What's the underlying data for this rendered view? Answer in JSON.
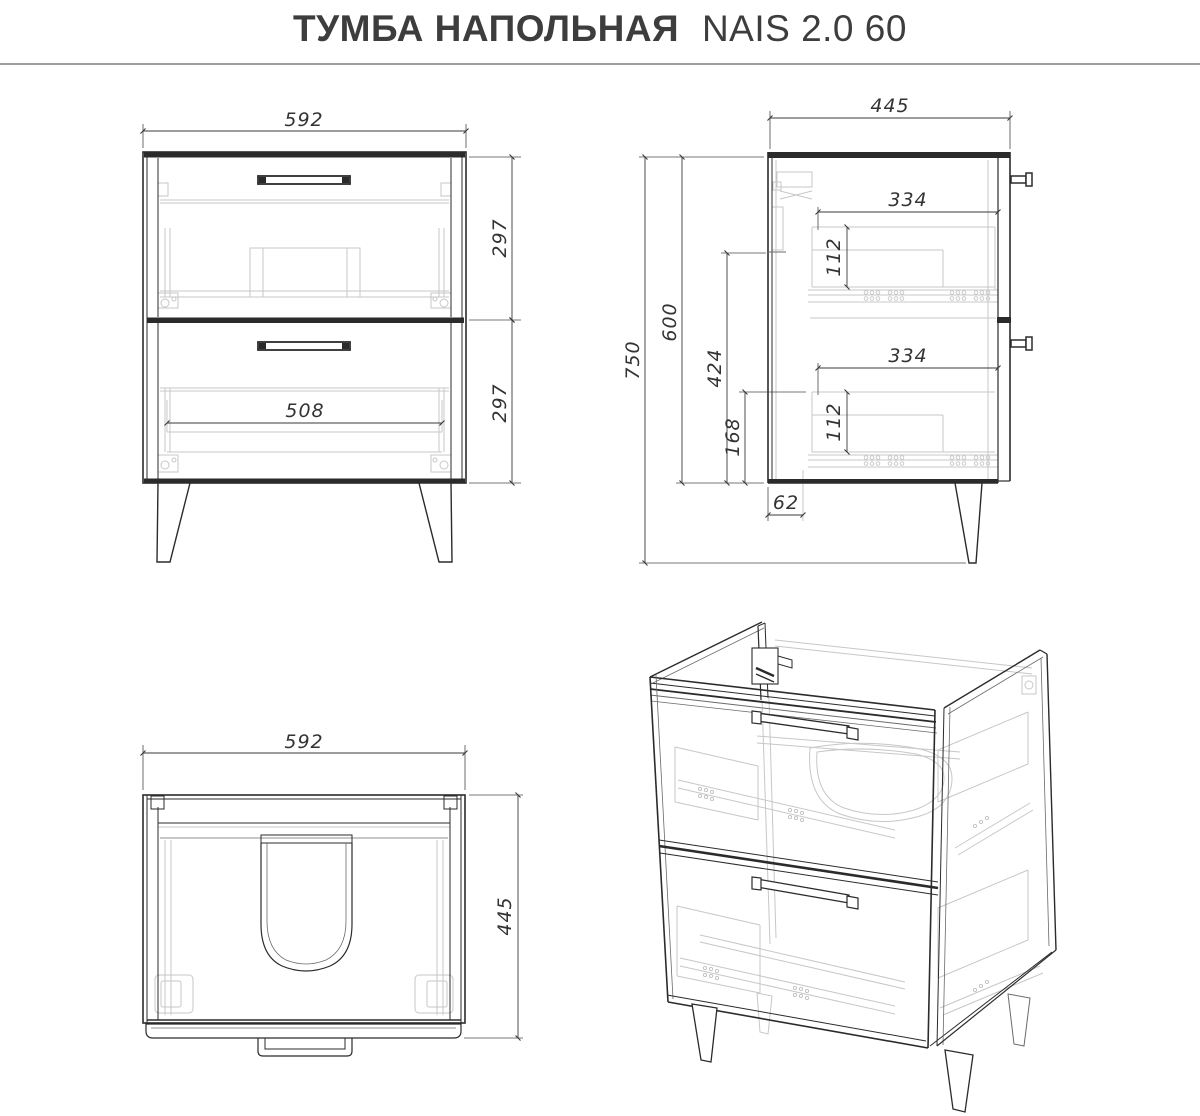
{
  "title": {
    "product": "ТУМБА НАПОЛЬНАЯ",
    "model": "NAIS 2.0 60"
  },
  "colors": {
    "background": "#ffffff",
    "line_main": "#2b2b2b",
    "line_internal": "#c7c7c7",
    "dimension": "#3a3a3a",
    "title_text": "#3d3d3d",
    "divider_rule": "#9e9e9e"
  },
  "views": {
    "front": {
      "overall_width": "592",
      "upper_drawer_height": "297",
      "lower_drawer_height": "297",
      "drawer_inner_width": "508"
    },
    "side": {
      "overall_depth": "445",
      "overall_height": "750",
      "body_height": "600",
      "inner_height": "424",
      "lower_zone_height": "168",
      "back_clearance": "62",
      "upper_drawer_depth": "334",
      "upper_drawer_side_height": "112",
      "lower_drawer_depth": "334",
      "lower_drawer_side_height": "112"
    },
    "top": {
      "overall_width": "592",
      "overall_depth": "445"
    }
  }
}
